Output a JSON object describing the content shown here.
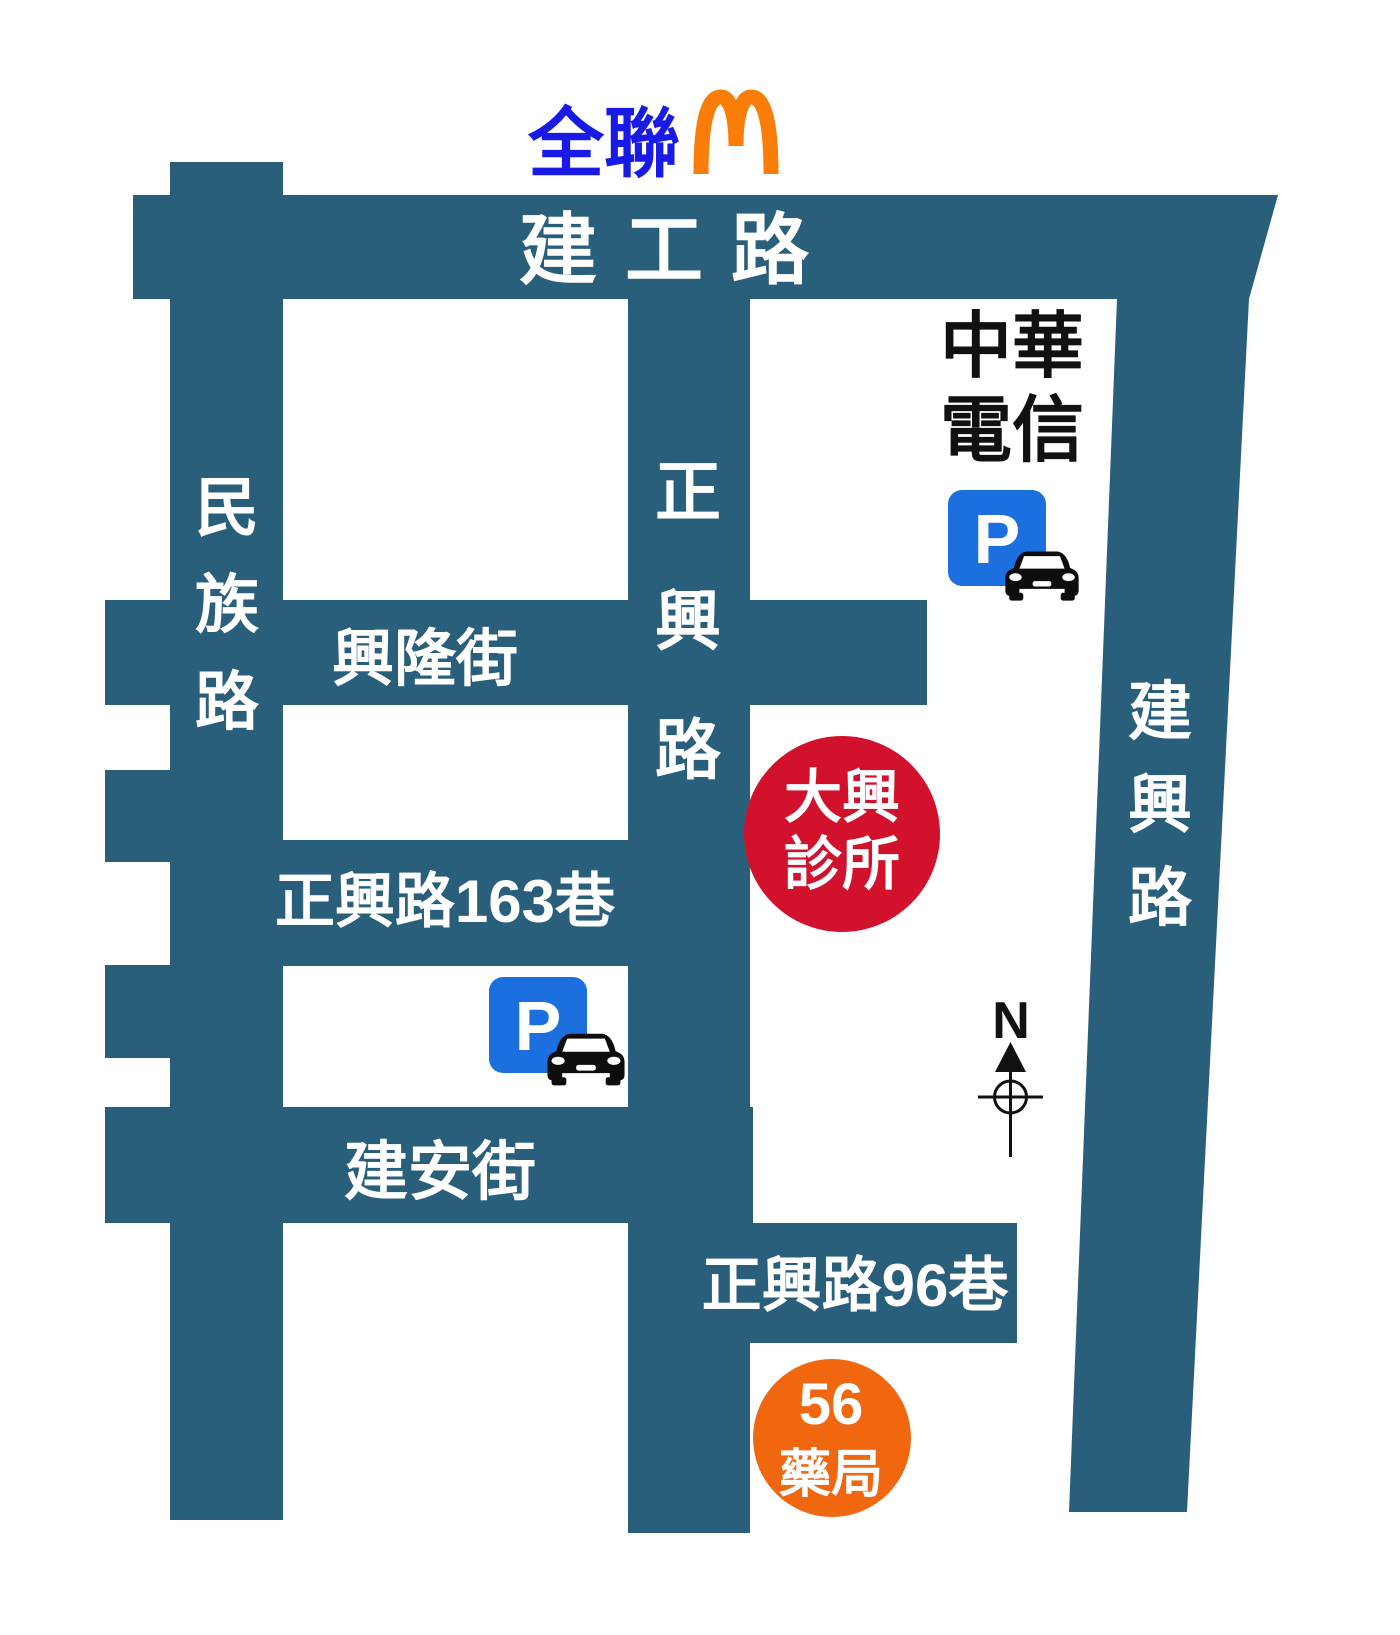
{
  "map": {
    "roads": {
      "jiangong": "建工路",
      "minzu": "民族路",
      "zhengxing": "正興路",
      "jianxing": "建興路",
      "xinglong": "興隆街",
      "lane163": "正興路163巷",
      "jianan": "建安街",
      "lane96": "正興路96巷"
    },
    "landmarks": {
      "pxmart": "全聯",
      "chunghwa_line1": "中華",
      "chunghwa_line2": "電信",
      "clinic_line1": "大興",
      "clinic_line2": "診所",
      "pharmacy_line1": "56",
      "pharmacy_line2": "藥局",
      "parking_letter": "P"
    },
    "compass": {
      "north_label": "N"
    },
    "colors": {
      "road_teal": "#2a5f7c",
      "pxmart_blue": "#1a1ae6",
      "mcdonalds_orange": "#f97d07",
      "parking_blue": "#1c6fdf",
      "clinic_red": "#d2122c",
      "pharmacy_orange": "#f0670f",
      "icon_black": "#0d0d0d"
    }
  }
}
